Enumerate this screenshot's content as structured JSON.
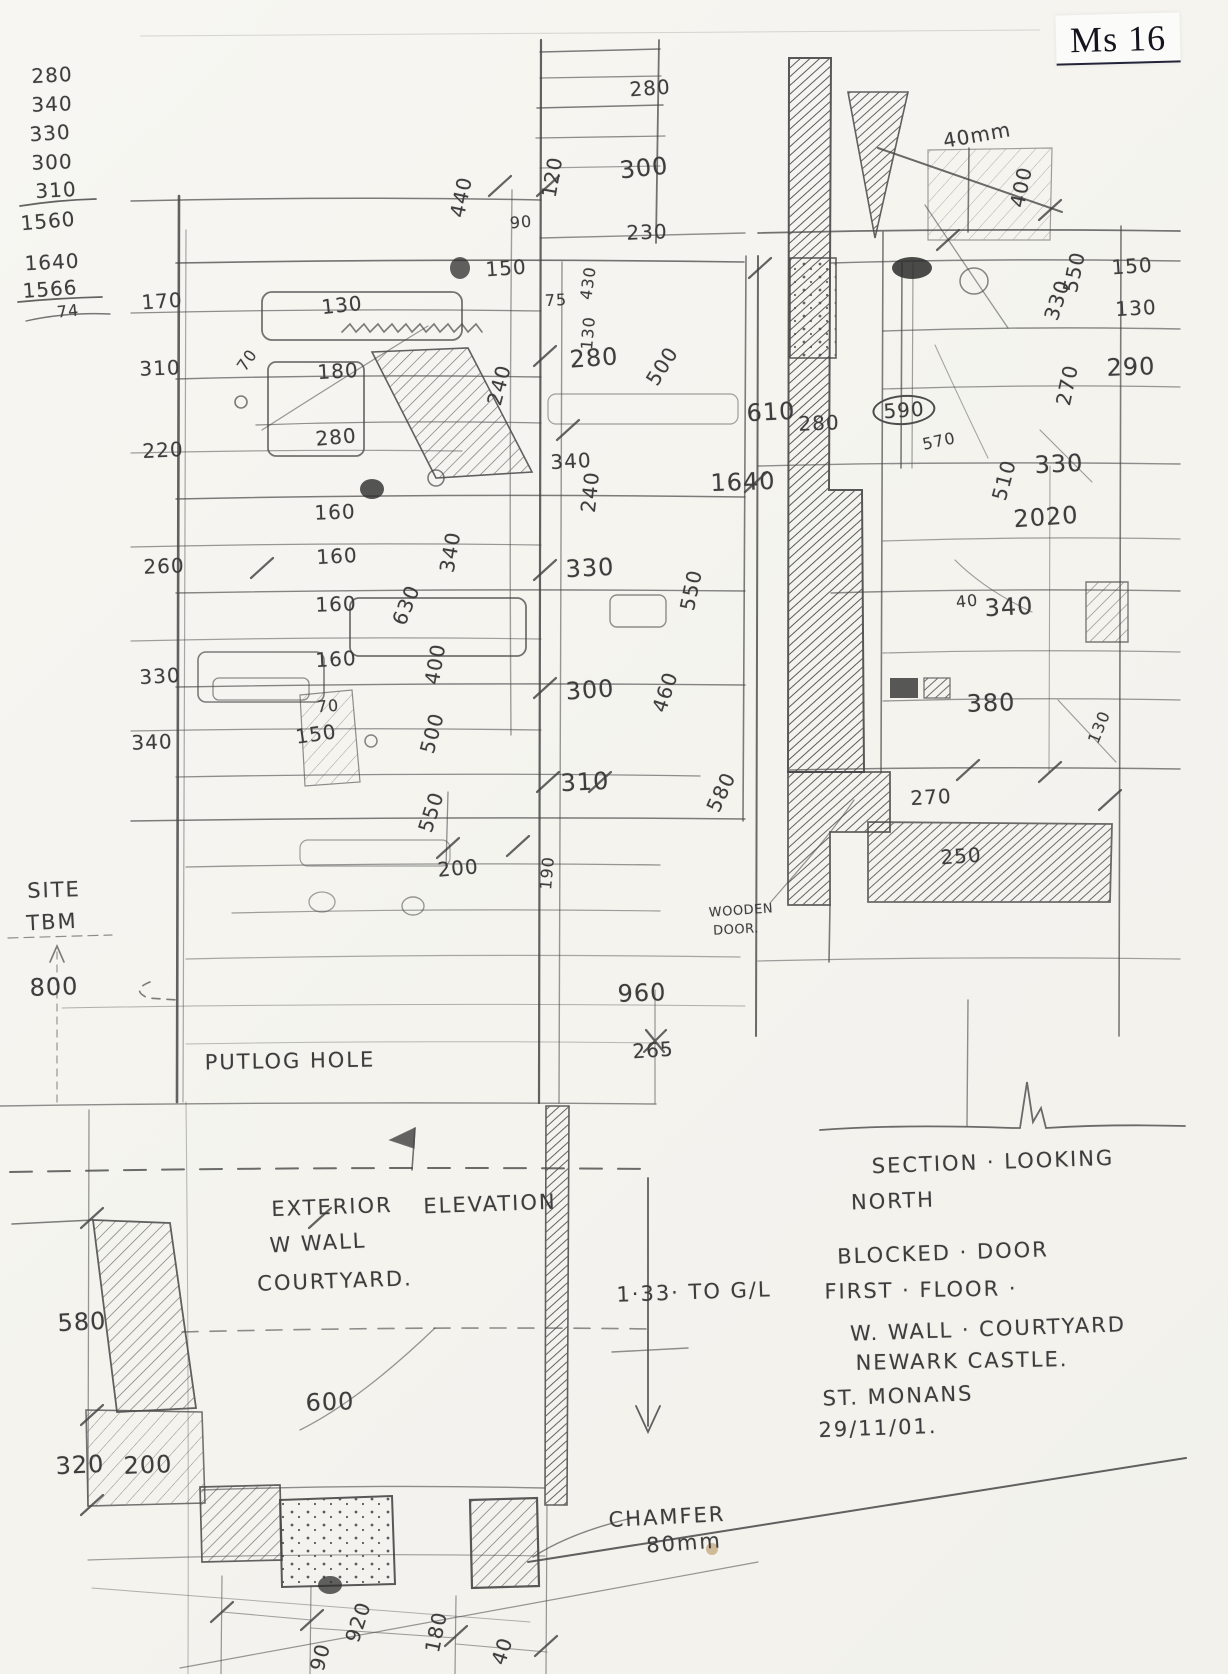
{
  "document": {
    "corner_label": "Ms 16",
    "drawing_titles": {
      "left": "EXTERIOR ELEVATION W WALL COURTYARD.",
      "right": "SECTION LOOKING NORTH"
    },
    "notes": [
      "SECTION · LOOKING",
      "NORTH",
      "BLOCKED · DOOR",
      "FIRST · FLOOR ·",
      "W. WALL · COURTYARD",
      "NEWARK CASTLE.",
      "ST. MONANS",
      "29/11/01."
    ],
    "calc_columns": [
      {
        "values": [
          "280",
          "340",
          "330",
          "300",
          "310"
        ],
        "total": "1560"
      },
      {
        "values": [
          "1640",
          "1566"
        ],
        "total": "74"
      }
    ]
  },
  "palette": {
    "paper": "#f6f5f1",
    "pencil": "#474747",
    "print_ink": "#14141e"
  },
  "annotations": [
    {
      "text": "280",
      "x": 52,
      "y": 75,
      "size": "md",
      "rot": -3
    },
    {
      "text": "340",
      "x": 52,
      "y": 104,
      "size": "md",
      "rot": -2
    },
    {
      "text": "330",
      "x": 50,
      "y": 133,
      "size": "md",
      "rot": -4
    },
    {
      "text": "300",
      "x": 52,
      "y": 162,
      "size": "md",
      "rot": -2
    },
    {
      "text": "310",
      "x": 56,
      "y": 190,
      "size": "md",
      "rot": -3
    },
    {
      "text": "1560",
      "x": 48,
      "y": 221,
      "size": "md",
      "rot": -5
    },
    {
      "text": "1640",
      "x": 52,
      "y": 262,
      "size": "md",
      "rot": -3
    },
    {
      "text": "1566",
      "x": 50,
      "y": 289,
      "size": "md",
      "rot": -4
    },
    {
      "text": "74",
      "x": 68,
      "y": 311,
      "size": "sm",
      "rot": -6
    },
    {
      "text": "170",
      "x": 162,
      "y": 301,
      "size": "md",
      "rot": -4
    },
    {
      "text": "310",
      "x": 160,
      "y": 368,
      "size": "md",
      "rot": -2
    },
    {
      "text": "220",
      "x": 163,
      "y": 450,
      "size": "md",
      "rot": -3
    },
    {
      "text": "260",
      "x": 164,
      "y": 566,
      "size": "md",
      "rot": -2
    },
    {
      "text": "330",
      "x": 160,
      "y": 676,
      "size": "md",
      "rot": -3
    },
    {
      "text": "340",
      "x": 152,
      "y": 742,
      "size": "md",
      "rot": -2
    },
    {
      "text": "70",
      "x": 247,
      "y": 360,
      "size": "sm",
      "rot": -55
    },
    {
      "text": "280",
      "x": 650,
      "y": 88,
      "size": "md",
      "rot": -4
    },
    {
      "text": "300",
      "x": 644,
      "y": 168,
      "size": "lg",
      "rot": -6
    },
    {
      "text": "230",
      "x": 647,
      "y": 232,
      "size": "md",
      "rot": -2
    },
    {
      "text": "440",
      "x": 461,
      "y": 197,
      "size": "md",
      "rot": -78
    },
    {
      "text": "120",
      "x": 552,
      "y": 177,
      "size": "md",
      "rot": -80
    },
    {
      "text": "90",
      "x": 521,
      "y": 222,
      "size": "sm",
      "rot": -5
    },
    {
      "text": "150",
      "x": 506,
      "y": 268,
      "size": "md",
      "rot": -4
    },
    {
      "text": "75",
      "x": 556,
      "y": 300,
      "size": "sm",
      "rot": -3
    },
    {
      "text": "430",
      "x": 588,
      "y": 283,
      "size": "sm",
      "rot": -82
    },
    {
      "text": "130",
      "x": 342,
      "y": 305,
      "size": "md",
      "rot": -6
    },
    {
      "text": "180",
      "x": 338,
      "y": 371,
      "size": "md",
      "rot": -3
    },
    {
      "text": "280",
      "x": 336,
      "y": 437,
      "size": "md",
      "rot": -5
    },
    {
      "text": "130",
      "x": 588,
      "y": 333,
      "size": "sm",
      "rot": -85
    },
    {
      "text": "280",
      "x": 594,
      "y": 358,
      "size": "lg",
      "rot": -4
    },
    {
      "text": "240",
      "x": 499,
      "y": 385,
      "size": "md",
      "rot": -75
    },
    {
      "text": "500",
      "x": 662,
      "y": 366,
      "size": "md",
      "rot": -58
    },
    {
      "text": "340",
      "x": 571,
      "y": 461,
      "size": "md",
      "rot": -3
    },
    {
      "text": "240",
      "x": 590,
      "y": 492,
      "size": "md",
      "rot": -84
    },
    {
      "text": "160",
      "x": 335,
      "y": 512,
      "size": "md",
      "rot": -2
    },
    {
      "text": "160",
      "x": 337,
      "y": 556,
      "size": "md",
      "rot": -3
    },
    {
      "text": "340",
      "x": 450,
      "y": 552,
      "size": "md",
      "rot": -80
    },
    {
      "text": "160",
      "x": 336,
      "y": 604,
      "size": "md",
      "rot": -2
    },
    {
      "text": "630",
      "x": 406,
      "y": 605,
      "size": "md",
      "rot": -68
    },
    {
      "text": "160",
      "x": 336,
      "y": 659,
      "size": "md",
      "rot": -3
    },
    {
      "text": "400",
      "x": 435,
      "y": 664,
      "size": "md",
      "rot": -80
    },
    {
      "text": "70",
      "x": 328,
      "y": 706,
      "size": "sm",
      "rot": -4
    },
    {
      "text": "150",
      "x": 316,
      "y": 734,
      "size": "md",
      "rot": -8
    },
    {
      "text": "500",
      "x": 432,
      "y": 733,
      "size": "md",
      "rot": -75
    },
    {
      "text": "330",
      "x": 590,
      "y": 568,
      "size": "lg",
      "rot": -3
    },
    {
      "text": "550",
      "x": 691,
      "y": 590,
      "size": "md",
      "rot": -78
    },
    {
      "text": "300",
      "x": 590,
      "y": 690,
      "size": "lg",
      "rot": -4
    },
    {
      "text": "460",
      "x": 665,
      "y": 692,
      "size": "md",
      "rot": -72
    },
    {
      "text": "310",
      "x": 585,
      "y": 782,
      "size": "lg",
      "rot": -3
    },
    {
      "text": "580",
      "x": 721,
      "y": 792,
      "size": "md",
      "rot": -65
    },
    {
      "text": "550",
      "x": 431,
      "y": 812,
      "size": "md",
      "rot": -72
    },
    {
      "text": "200",
      "x": 458,
      "y": 868,
      "size": "md",
      "rot": -5
    },
    {
      "text": "190",
      "x": 547,
      "y": 873,
      "size": "sm",
      "rot": -85
    },
    {
      "text": "40mm",
      "x": 977,
      "y": 135,
      "size": "md",
      "rot": -10
    },
    {
      "text": "400",
      "x": 1021,
      "y": 187,
      "size": "md",
      "rot": -78
    },
    {
      "text": "150",
      "x": 1132,
      "y": 266,
      "size": "md",
      "rot": -4
    },
    {
      "text": "550",
      "x": 1074,
      "y": 272,
      "size": "md",
      "rot": -78
    },
    {
      "text": "330",
      "x": 1057,
      "y": 300,
      "size": "md",
      "rot": -72
    },
    {
      "text": "130",
      "x": 1136,
      "y": 308,
      "size": "md",
      "rot": -3
    },
    {
      "text": "290",
      "x": 1131,
      "y": 367,
      "size": "lg",
      "rot": -2
    },
    {
      "text": "270",
      "x": 1067,
      "y": 385,
      "size": "md",
      "rot": -78
    },
    {
      "text": "610",
      "x": 771,
      "y": 412,
      "size": "lg",
      "rot": -3
    },
    {
      "text": "280",
      "x": 819,
      "y": 423,
      "size": "md",
      "rot": -2
    },
    {
      "text": "590",
      "x": 904,
      "y": 410,
      "size": "md",
      "rot": -4,
      "circled": true
    },
    {
      "text": "570",
      "x": 939,
      "y": 441,
      "size": "sm",
      "rot": -12
    },
    {
      "text": "1640",
      "x": 743,
      "y": 482,
      "size": "lg",
      "rot": -2
    },
    {
      "text": "510",
      "x": 1004,
      "y": 480,
      "size": "md",
      "rot": -75
    },
    {
      "text": "330",
      "x": 1059,
      "y": 464,
      "size": "lg",
      "rot": -3
    },
    {
      "text": "2020",
      "x": 1046,
      "y": 517,
      "size": "lg",
      "rot": -4
    },
    {
      "text": "40",
      "x": 967,
      "y": 601,
      "size": "sm",
      "rot": -6
    },
    {
      "text": "340",
      "x": 1009,
      "y": 607,
      "size": "lg",
      "rot": -3
    },
    {
      "text": "380",
      "x": 991,
      "y": 703,
      "size": "lg",
      "rot": -2
    },
    {
      "text": "130",
      "x": 1099,
      "y": 727,
      "size": "sm",
      "rot": -68
    },
    {
      "text": "270",
      "x": 931,
      "y": 797,
      "size": "md",
      "rot": -3
    },
    {
      "text": "250",
      "x": 961,
      "y": 856,
      "size": "md",
      "rot": -4
    },
    {
      "text": "WOODEN",
      "x": 741,
      "y": 911,
      "size": "xs",
      "rot": -4
    },
    {
      "text": "DOOR.",
      "x": 736,
      "y": 930,
      "size": "xs",
      "rot": -3
    },
    {
      "text": "960",
      "x": 642,
      "y": 993,
      "size": "lg",
      "rot": -2
    },
    {
      "text": "265",
      "x": 653,
      "y": 1050,
      "size": "md",
      "rot": -4
    },
    {
      "text": "SITE",
      "x": 54,
      "y": 890,
      "size": "note",
      "rot": -2
    },
    {
      "text": "TBM",
      "x": 52,
      "y": 922,
      "size": "note",
      "rot": -3
    },
    {
      "text": "800",
      "x": 54,
      "y": 987,
      "size": "lg",
      "rot": -2
    },
    {
      "text": "PUTLOG HOLE",
      "x": 290,
      "y": 1061,
      "size": "note",
      "rot": -1
    },
    {
      "text": "EXTERIOR",
      "x": 332,
      "y": 1207,
      "size": "note",
      "rot": -2
    },
    {
      "text": "ELEVATION",
      "x": 490,
      "y": 1204,
      "size": "note",
      "rot": -2
    },
    {
      "text": "W WALL",
      "x": 318,
      "y": 1243,
      "size": "note",
      "rot": -3
    },
    {
      "text": "COURTYARD.",
      "x": 335,
      "y": 1281,
      "size": "note",
      "rot": -2
    },
    {
      "text": "580",
      "x": 82,
      "y": 1322,
      "size": "lg",
      "rot": -3
    },
    {
      "text": "600",
      "x": 330,
      "y": 1402,
      "size": "lg",
      "rot": -2
    },
    {
      "text": "320",
      "x": 80,
      "y": 1465,
      "size": "lg",
      "rot": -3
    },
    {
      "text": "200",
      "x": 148,
      "y": 1465,
      "size": "lg",
      "rot": -2
    },
    {
      "text": "1·33· TO G/L",
      "x": 694,
      "y": 1292,
      "size": "note",
      "rot": -2
    },
    {
      "text": "CHAMFER",
      "x": 667,
      "y": 1517,
      "size": "note",
      "rot": -3
    },
    {
      "text": "80mm",
      "x": 684,
      "y": 1543,
      "size": "note",
      "rot": -4
    },
    {
      "text": "920",
      "x": 358,
      "y": 1622,
      "size": "md",
      "rot": -72
    },
    {
      "text": "180",
      "x": 436,
      "y": 1632,
      "size": "md",
      "rot": -78
    },
    {
      "text": "40",
      "x": 502,
      "y": 1651,
      "size": "md",
      "rot": -72
    },
    {
      "text": "90",
      "x": 320,
      "y": 1657,
      "size": "md",
      "rot": -75
    },
    {
      "text": "SECTION · LOOKING",
      "x": 993,
      "y": 1162,
      "size": "note",
      "rot": -2
    },
    {
      "text": "NORTH",
      "x": 893,
      "y": 1201,
      "size": "note",
      "rot": -2
    },
    {
      "text": "BLOCKED · DOOR",
      "x": 943,
      "y": 1253,
      "size": "note",
      "rot": -2
    },
    {
      "text": "FIRST · FLOOR ·",
      "x": 921,
      "y": 1290,
      "size": "note",
      "rot": -1
    },
    {
      "text": "W. WALL · COURTYARD",
      "x": 988,
      "y": 1329,
      "size": "note",
      "rot": -2
    },
    {
      "text": "NEWARK CASTLE.",
      "x": 962,
      "y": 1361,
      "size": "note",
      "rot": -1
    },
    {
      "text": "ST. MONANS",
      "x": 898,
      "y": 1396,
      "size": "note",
      "rot": -2
    },
    {
      "text": "29/11/01.",
      "x": 878,
      "y": 1428,
      "size": "note",
      "rot": -2
    }
  ]
}
